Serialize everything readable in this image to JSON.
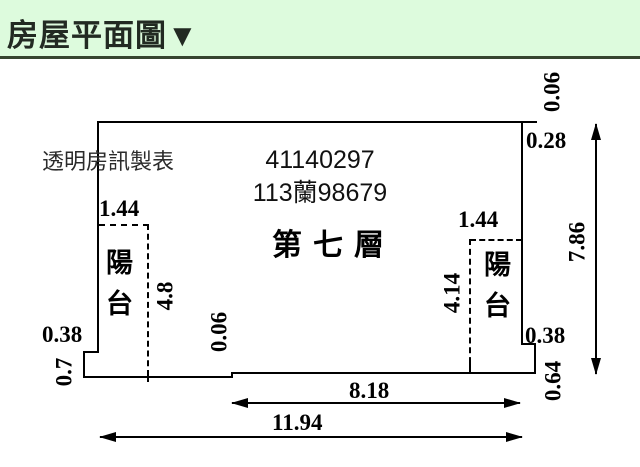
{
  "header": {
    "title": "房屋平面圖▼"
  },
  "plan": {
    "maker_label": "透明房訊製表",
    "case_number": "41140297",
    "permit_number": "113蘭98679",
    "floor_label": "第七層",
    "balcony_left_label": "陽台",
    "balcony_right_label": "陽台",
    "dims": {
      "top_right_offset": "0.06",
      "right_top_inset": "0.28",
      "right_total_height": "7.86",
      "balcony_left_width": "1.44",
      "balcony_left_depth": "4.8",
      "balcony_right_width": "1.44",
      "balcony_right_depth": "4.14",
      "left_step_width": "0.38",
      "left_step_height": "0.7",
      "bottom_step_offset": "0.06",
      "right_step_width": "0.38",
      "right_step_height": "0.64",
      "bottom_inner_width": "8.18",
      "bottom_total_width": "11.94"
    }
  },
  "colors": {
    "header_bg": "#ddfbdd",
    "header_rule": "#36452f",
    "line": "#000000",
    "background": "#ffffff"
  }
}
